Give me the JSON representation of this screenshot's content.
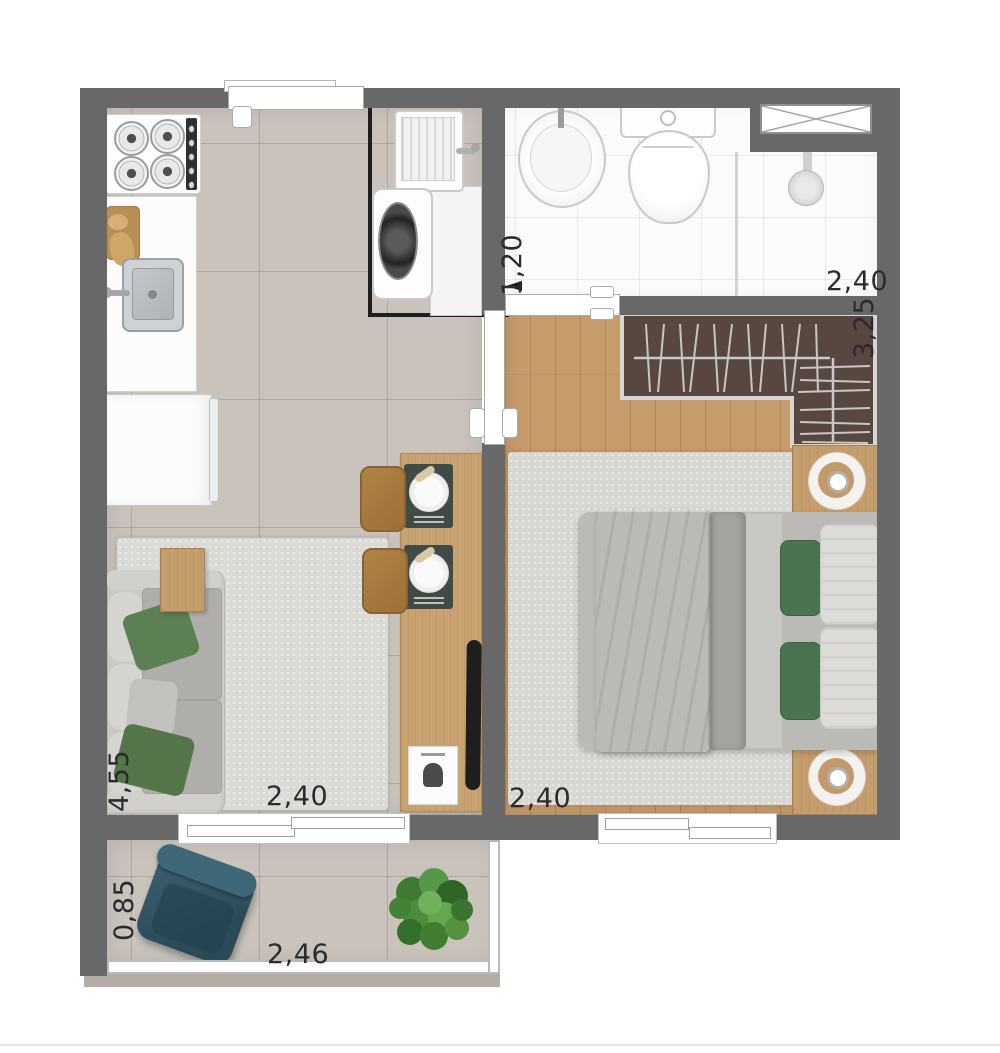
{
  "type": "apartment-floor-plan",
  "dims": {
    "bathroom_width": "1,20",
    "bathroom_length": "2,40",
    "closet_wall": "3,25",
    "bedroom_width": "2,40",
    "living_length": "4,55",
    "living_width": "2,40",
    "balcony_depth": "0,85",
    "balcony_width": "2,46"
  },
  "colors": {
    "wall": "#686868",
    "tile_floor": "#c9c3bc",
    "wood_floor": "#c69c6d",
    "counter_wood": "#c9a272",
    "closet_interior": "#584741",
    "bathroom_tile": "#fbfbfa",
    "rug": "#dbdad6",
    "sofa": "#cbc9c6",
    "bed_blanket_green": "#4d7152",
    "pillow_green": "#4a7350",
    "armchair_teal": "#2e4f5e",
    "plant_green": "#4c8c3c",
    "laundry_outline": "#1f1f1f",
    "dimension_text": "#2b2b2b"
  }
}
